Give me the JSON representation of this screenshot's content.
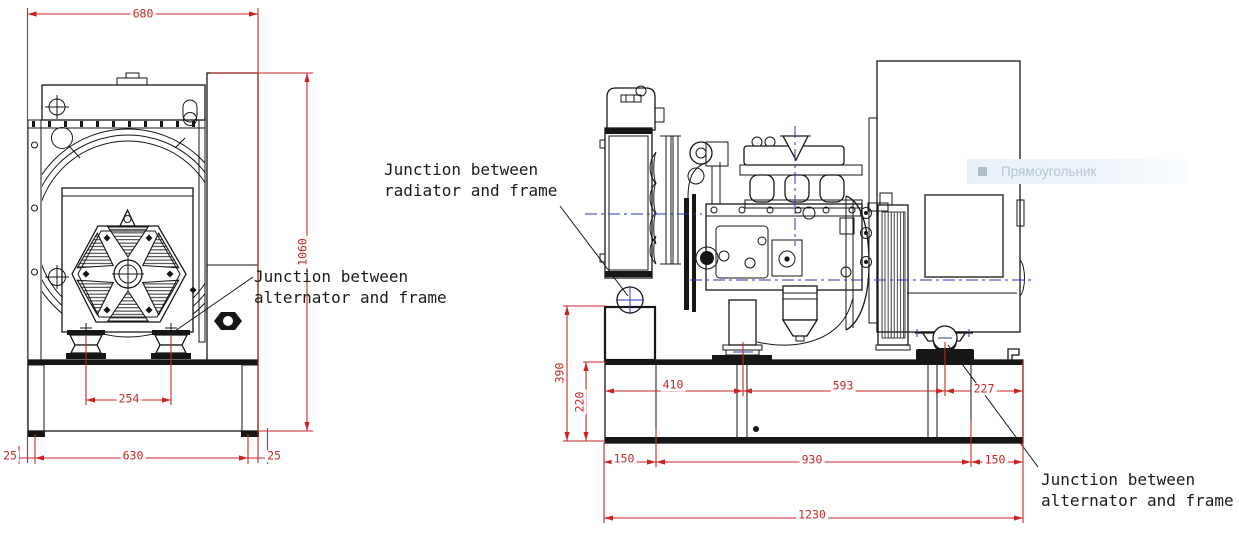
{
  "drawing_title": "Generator set outline drawing, front and side views",
  "dimensions": {
    "front": {
      "overall_width": "680",
      "overall_height": "1060",
      "mount_spacing": "254",
      "frame_length": "630",
      "overhang_left": "25",
      "overhang_right": "25"
    },
    "side": {
      "riser_height": "390",
      "frame_height": "220",
      "radiator_to_engine_mount": "410",
      "engine_to_alternator_mount": "593",
      "alternator_mount_to_end": "227",
      "end_offset_left": "150",
      "mount_span": "930",
      "end_offset_right": "150",
      "overall_length": "1230"
    }
  },
  "annotations": {
    "radiator_frame": {
      "line1": "Junction between",
      "line2": "radiator and frame"
    },
    "alternator_frame_front": {
      "line1": "Junction between",
      "line2": "alternator and frame"
    },
    "alternator_frame_side": {
      "line1": "Junction between",
      "line2": "alternator and frame"
    }
  },
  "overlay_tooltip": {
    "label": "Прямоугольник"
  },
  "colors": {
    "line_black": "#161616",
    "dimension_red": "#c82626",
    "centerline_blue": "#2b36b5",
    "tooltip_bg": "#edf4fb",
    "tooltip_text": "#b6c5d5",
    "tooltip_icon": "#a3afbd"
  }
}
